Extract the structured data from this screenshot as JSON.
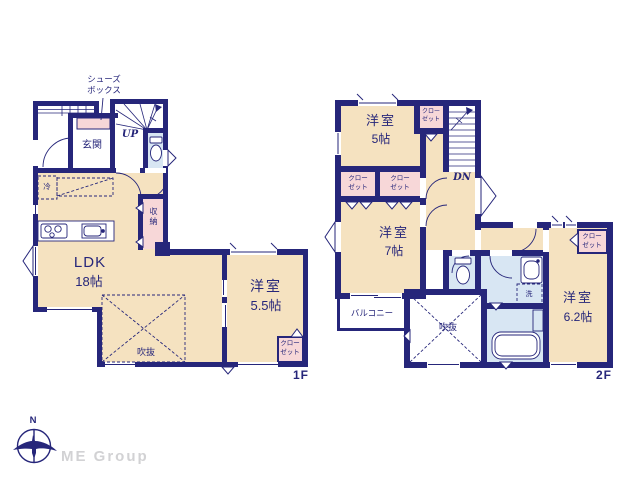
{
  "floor1": {
    "label": "1F",
    "shoes_box_line1": "シューズ",
    "shoes_box_line2": "ボックス",
    "genkan": "玄関",
    "stairs": "UP",
    "fridge": "冷",
    "storage": "収納",
    "ldk_name": "LDK",
    "ldk_size": "18帖",
    "bedroom_name": "洋室",
    "bedroom_size": "5.5帖",
    "void_label": "吹抜",
    "closet_line1": "クロー",
    "closet_line2": "ゼット"
  },
  "floor2": {
    "label": "2F",
    "stairs": "DN",
    "bedroom5_name": "洋室",
    "bedroom5_size": "5帖",
    "bedroom7_name": "洋室",
    "bedroom7_size": "7帖",
    "bedroom62_name": "洋室",
    "bedroom62_size": "6.2帖",
    "balcony": "バルコニー",
    "void_label": "吹抜",
    "laundry": "洗",
    "closet_line1": "クロー",
    "closet_line2": "ゼット"
  },
  "footer": {
    "north": "N",
    "brand": "ME Group"
  },
  "colors": {
    "wall_navy": "#26267a",
    "room_tan": "#f5e2c0",
    "closet_pink": "#f7d7d8",
    "wet_area_blue": "#d8e6f3",
    "text_navy": "#26267a",
    "brand_gray": "#d2d2d4"
  }
}
